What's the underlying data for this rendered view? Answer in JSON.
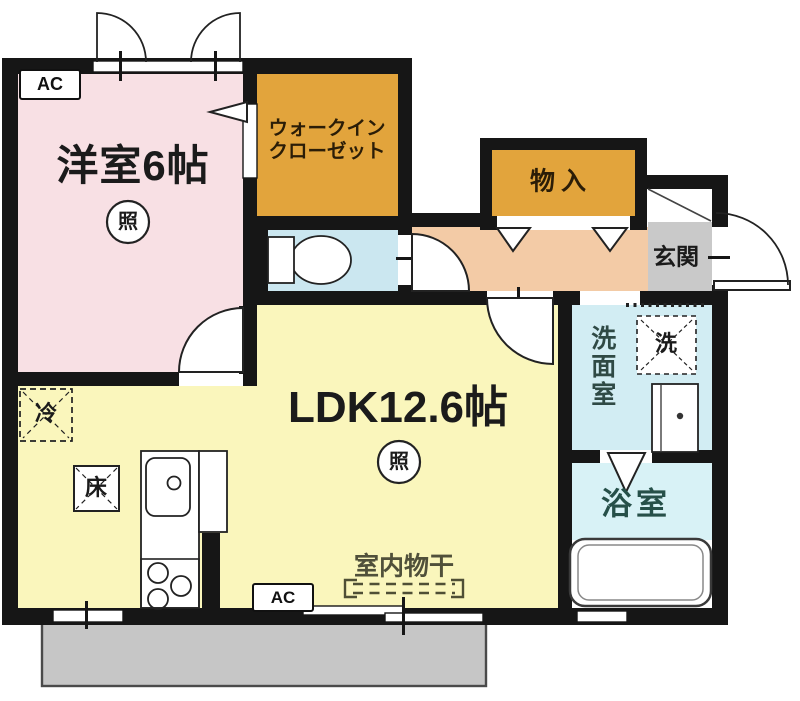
{
  "rooms": {
    "bedroom": {
      "label": "洋室6帖",
      "color": "#F8E0E4"
    },
    "walk_in_closet": {
      "label1": "ウォークイン",
      "label2": "クローゼット",
      "color": "#E2A43C"
    },
    "storage": {
      "label": "物入",
      "color": "#E2A43C"
    },
    "entrance": {
      "label": "玄関",
      "tile_color": "#C9C9C9"
    },
    "hall": {
      "color": "#F3CBA6"
    },
    "toilet": {
      "color": "#CBE7F0"
    },
    "ldk": {
      "label": "LDK12.6帖",
      "color": "#FAF6BC"
    },
    "washroom": {
      "label": "洗面室",
      "color": "#D2EDF3"
    },
    "bathroom": {
      "label": "浴室",
      "color": "#D8F2F6"
    },
    "balcony": {
      "color": "#C6C6C6"
    }
  },
  "markers": {
    "ac": "AC",
    "light": "照",
    "fridge": "冷",
    "floor_storage": "床",
    "washer": "洗",
    "indoor_drying": "室内物干"
  },
  "wall_color": "#161616"
}
